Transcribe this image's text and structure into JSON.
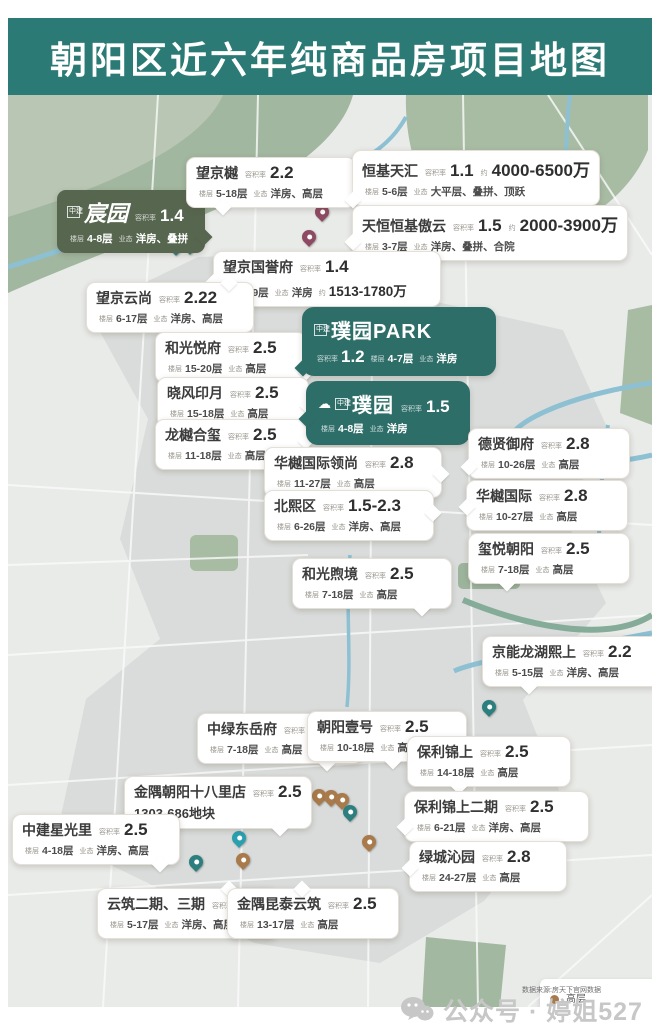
{
  "page": {
    "title": "朝阳区近六年纯商品房项目地图",
    "watermark_text": "公众号 · 婷姐527",
    "source_note": "数据来源:房天下官网数据"
  },
  "labels": {
    "far": "容积率",
    "floors": "楼层",
    "type": "业态",
    "approx": "约"
  },
  "colors": {
    "header_bg": "#2b7a75",
    "dark_green_callout": "#57664f",
    "dark_teal_callout": "#2e6e69",
    "pin_highrise": "#a97a4b",
    "pin_flats_highrise": "#2c7f7e",
    "pin_villa": "#8e4a62",
    "pin_bright": "#2a9fb0"
  },
  "legend": {
    "items": [
      {
        "color": "#a97a4b",
        "label": "高层"
      },
      {
        "color": "#2c7f7e",
        "label": "洋房、高层"
      },
      {
        "color": "#8e4a62",
        "label": "合院、叠拼、大平层\n顶跃、洋房"
      }
    ]
  },
  "projects": [
    {
      "name": "宸园",
      "far": "1.4",
      "floors": "4-8层",
      "types": "洋房、叠拼",
      "variant": "dark-green",
      "logo": "中建",
      "x": 49,
      "y": 95,
      "w": 128,
      "tail": {
        "s": "right",
        "p": 65
      }
    },
    {
      "name": "望京樾",
      "far": "2.2",
      "floors": "5-18层",
      "types": "洋房、高层",
      "x": 178,
      "y": 62,
      "w": 150,
      "tail": {
        "s": "bottom",
        "p": 18
      }
    },
    {
      "name": "恒基天汇",
      "far": "1.1",
      "price": "4000-6500万",
      "price_line": 1,
      "floors": "5-6层",
      "types": "大平层、叠拼、顶跃",
      "x": 344,
      "y": 55,
      "w": 196,
      "tail": {
        "s": "left",
        "p": 80
      }
    },
    {
      "name": "天恒恒基傲云",
      "far": "1.5",
      "price": "2000-3900万",
      "price_line": 1,
      "floors": "3-7层",
      "types": "洋房、叠拼、合院",
      "x": 344,
      "y": 110,
      "w": 214,
      "tail": {
        "s": "left",
        "p": 55
      }
    },
    {
      "name": "望京国誉府",
      "far": "1.4",
      "floors": "8-9层",
      "types": "洋房",
      "price": "1513-1780万",
      "price_line": 2,
      "x": 205,
      "y": 156,
      "w": 208,
      "tail": {
        "s": "left",
        "p": 45
      }
    },
    {
      "name": "望京云尚",
      "far": "2.22",
      "floors": "6-17层",
      "types": "洋房、高层",
      "x": 78,
      "y": 187,
      "w": 148,
      "tail": {
        "s": "top",
        "p": 82
      }
    },
    {
      "name": "和光悦府",
      "far": "2.5",
      "floors": "15-20层",
      "types": "高层",
      "x": 147,
      "y": 237,
      "w": 132,
      "tail": {
        "s": "right",
        "p": 68
      }
    },
    {
      "name": "晓风印月",
      "far": "2.5",
      "floors": "15-18层",
      "types": "高层",
      "x": 149,
      "y": 282,
      "w": 132,
      "tail": {
        "s": "right",
        "p": 45
      }
    },
    {
      "name": "龙樾合玺",
      "far": "2.5",
      "floors": "11-18层",
      "types": "高层",
      "x": 147,
      "y": 324,
      "w": 132,
      "tail": {
        "s": "right",
        "p": 30
      }
    },
    {
      "name": "璞园PARK",
      "far": "1.2",
      "far_line": 2,
      "floors": "4-7层",
      "types": "洋房",
      "variant": "dark-teal",
      "logo": "中建",
      "x": 294,
      "y": 212,
      "w": 170,
      "tail": {
        "s": "left",
        "p": 80
      }
    },
    {
      "name": "璞园",
      "far": "1.5",
      "floors": "4-8层",
      "types": "洋房",
      "variant": "dark-teal",
      "cloud": true,
      "logo": "中建",
      "x": 298,
      "y": 286,
      "w": 140,
      "tail": {
        "s": "left",
        "p": 50
      }
    },
    {
      "name": "华樾国际领尚",
      "far": "2.8",
      "floors": "11-27层",
      "types": "高层",
      "x": 256,
      "y": 352,
      "w": 158,
      "tail": {
        "s": "right",
        "p": 40
      }
    },
    {
      "name": "北熙区",
      "far": "1.5-2.3",
      "floors": "6-26层",
      "types": "洋房、高层",
      "x": 256,
      "y": 395,
      "w": 150,
      "tail": {
        "s": "right",
        "p": 32
      }
    },
    {
      "name": "德贤御府",
      "far": "2.8",
      "floors": "10-26层",
      "types": "高层",
      "x": 460,
      "y": 333,
      "w": 142,
      "tail": {
        "s": "left",
        "p": 65
      }
    },
    {
      "name": "华樾国际",
      "far": "2.8",
      "floors": "10-27层",
      "types": "高层",
      "x": 458,
      "y": 385,
      "w": 142,
      "tail": {
        "s": "left",
        "p": 40
      }
    },
    {
      "name": "玺悦朝阳",
      "far": "2.5",
      "floors": "7-18层",
      "types": "高层",
      "x": 460,
      "y": 438,
      "w": 142,
      "tail": {
        "s": "bottom",
        "p": 20
      }
    },
    {
      "name": "和光煦境",
      "far": "2.5",
      "floors": "7-18层",
      "types": "高层",
      "x": 284,
      "y": 463,
      "w": 140,
      "tail": {
        "s": "bottom",
        "p": 78
      }
    },
    {
      "name": "京能龙湖熙上",
      "far": "2.2",
      "floors": "5-15层",
      "types": "洋房、高层",
      "x": 474,
      "y": 541,
      "w": 165,
      "tail": {
        "s": "bottom",
        "p": 22
      }
    },
    {
      "name": "中绿东岳府",
      "far": "2.5",
      "floors": "7-18层",
      "types": "高层",
      "x": 189,
      "y": 618,
      "w": 146,
      "tail": {
        "s": "bottom",
        "p": 75
      }
    },
    {
      "name": "朝阳壹号",
      "far": "2.5",
      "floors": "10-18层",
      "types": "高层",
      "x": 299,
      "y": 616,
      "w": 140,
      "tail": {
        "s": "bottom",
        "p": 50
      }
    },
    {
      "name": "保利锦上",
      "far": "2.5",
      "floors": "14-18层",
      "types": "高层",
      "x": 399,
      "y": 641,
      "w": 144,
      "tail": {
        "s": "bottom",
        "p": 28
      }
    },
    {
      "name": "金隅朝阳十八里店",
      "far": "2.5",
      "extra": "1303-686地块",
      "x": 116,
      "y": 681,
      "w": 168,
      "tail": {
        "s": "bottom",
        "p": 80
      }
    },
    {
      "name": "保利锦上二期",
      "far": "2.5",
      "floors": "6-21层",
      "types": "洋房、高层",
      "x": 396,
      "y": 696,
      "w": 165,
      "tail": {
        "s": "left",
        "p": 60
      }
    },
    {
      "name": "中建星光里",
      "far": "2.5",
      "floors": "4-18层",
      "types": "洋房、高层",
      "x": 4,
      "y": 719,
      "w": 148,
      "tail": {
        "s": "bottom",
        "p": 85
      }
    },
    {
      "name": "绿城沁园",
      "far": "2.8",
      "floors": "24-27层",
      "types": "高层",
      "x": 401,
      "y": 746,
      "w": 138,
      "tail": {
        "s": "left",
        "p": 40
      }
    },
    {
      "name": "云筑二期、三期",
      "far": "2.5",
      "floors": "5-17层",
      "types": "洋房、高层",
      "x": 89,
      "y": 793,
      "w": 160,
      "tail": {
        "s": "top",
        "p": 70
      }
    },
    {
      "name": "金隅昆泰云筑",
      "far": "2.5",
      "floors": "13-17层",
      "types": "高层",
      "x": 219,
      "y": 793,
      "w": 152,
      "tail": {
        "s": "top",
        "p": 40
      }
    }
  ],
  "pins": [
    {
      "x": 168,
      "y": 157,
      "c": "#2c7f7e"
    },
    {
      "x": 182,
      "y": 156,
      "c": "#2c7f7e"
    },
    {
      "x": 174,
      "y": 145,
      "c": "#2c7f7e"
    },
    {
      "x": 314,
      "y": 123,
      "c": "#8e4a62"
    },
    {
      "x": 301,
      "y": 148,
      "c": "#8e4a62"
    },
    {
      "x": 268,
      "y": 278,
      "c": "#a97a4b"
    },
    {
      "x": 278,
      "y": 287,
      "c": "#a97a4b"
    },
    {
      "x": 288,
      "y": 286,
      "c": "#a97a4b"
    },
    {
      "x": 413,
      "y": 369,
      "c": "#a97a4b"
    },
    {
      "x": 425,
      "y": 365,
      "c": "#a97a4b"
    },
    {
      "x": 416,
      "y": 384,
      "c": "#a97a4b"
    },
    {
      "x": 388,
      "y": 384,
      "c": "#2c7f7e"
    },
    {
      "x": 408,
      "y": 509,
      "c": "#a97a4b"
    },
    {
      "x": 424,
      "y": 506,
      "c": "#a97a4b"
    },
    {
      "x": 481,
      "y": 618,
      "c": "#2c7f7e"
    },
    {
      "x": 311,
      "y": 707,
      "c": "#a97a4b"
    },
    {
      "x": 323,
      "y": 708,
      "c": "#a97a4b"
    },
    {
      "x": 334,
      "y": 711,
      "c": "#a97a4b"
    },
    {
      "x": 342,
      "y": 723,
      "c": "#2c7f7e"
    },
    {
      "x": 361,
      "y": 753,
      "c": "#a97a4b"
    },
    {
      "x": 231,
      "y": 749,
      "c": "#2a9fb0"
    },
    {
      "x": 147,
      "y": 767,
      "c": "#2c7f7e"
    },
    {
      "x": 188,
      "y": 773,
      "c": "#2c7f7e"
    },
    {
      "x": 235,
      "y": 771,
      "c": "#a97a4b"
    }
  ]
}
